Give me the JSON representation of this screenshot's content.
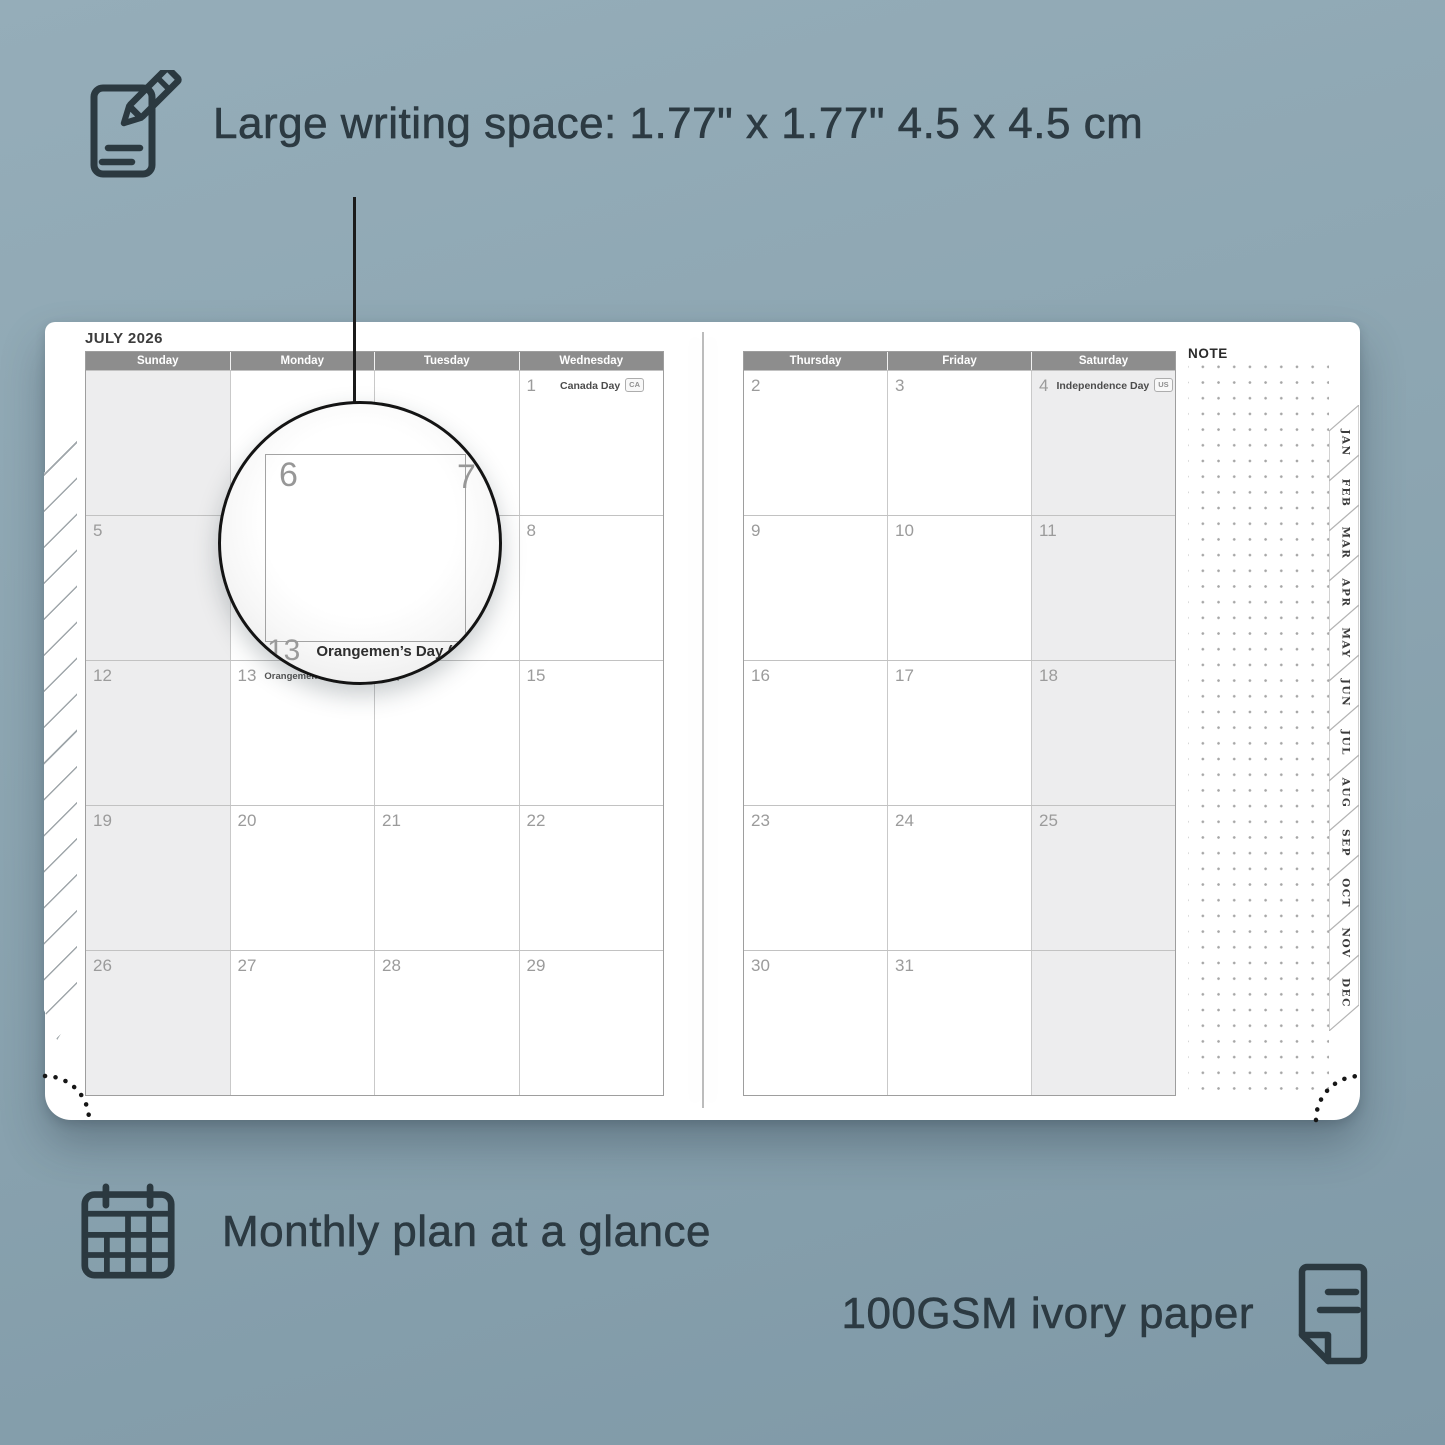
{
  "features": {
    "writing_space": {
      "icon": "pencil-note-icon",
      "label": "Large writing space: 1.77\" x 1.77\" 4.5 x 4.5 cm"
    },
    "monthly_plan": {
      "icon": "calendar-grid-icon",
      "label": "Monthly plan at a glance"
    },
    "paper": {
      "icon": "paper-icon",
      "label": "100GSM ivory paper"
    }
  },
  "planner": {
    "month_title": "JULY 2026",
    "note_label": "NOTE",
    "month_tabs": [
      "JAN",
      "FEB",
      "MAR",
      "APR",
      "MAY",
      "JUN",
      "JUL",
      "AUG",
      "SEP",
      "OCT",
      "NOV",
      "DEC"
    ],
    "left_page": {
      "headers": [
        "Sunday",
        "Monday",
        "Tuesday",
        "Wednesday"
      ],
      "shaded_column": 0,
      "rows": [
        [
          {
            "day": ""
          },
          {
            "day": ""
          },
          {
            "day": ""
          },
          {
            "day": "1",
            "holiday": "Canada Day",
            "badge": "CA",
            "holiday_align": "right"
          }
        ],
        [
          {
            "day": "5"
          },
          {
            "day": "6"
          },
          {
            "day": "7"
          },
          {
            "day": "8"
          }
        ],
        [
          {
            "day": "12"
          },
          {
            "day": "13",
            "holiday": "Orangemen’s Day (n.i.)",
            "badge": "UK",
            "holiday_align": "inline"
          },
          {
            "day": "14"
          },
          {
            "day": "15"
          }
        ],
        [
          {
            "day": "19"
          },
          {
            "day": "20"
          },
          {
            "day": "21"
          },
          {
            "day": "22"
          }
        ],
        [
          {
            "day": "26"
          },
          {
            "day": "27"
          },
          {
            "day": "28"
          },
          {
            "day": "29"
          }
        ]
      ]
    },
    "right_page": {
      "headers": [
        "Thursday",
        "Friday",
        "Saturday"
      ],
      "shaded_column": 2,
      "rows": [
        [
          {
            "day": "2"
          },
          {
            "day": "3"
          },
          {
            "day": "4",
            "holiday": "Independence Day",
            "badge": "US",
            "holiday_align": "right"
          }
        ],
        [
          {
            "day": "9"
          },
          {
            "day": "10"
          },
          {
            "day": "11"
          }
        ],
        [
          {
            "day": "16"
          },
          {
            "day": "17"
          },
          {
            "day": "18"
          }
        ],
        [
          {
            "day": "23"
          },
          {
            "day": "24"
          },
          {
            "day": "25"
          }
        ],
        [
          {
            "day": "30"
          },
          {
            "day": "31"
          },
          {
            "day": ""
          }
        ]
      ]
    },
    "magnifier": {
      "day": "6",
      "next_day": "7",
      "below_day": "13",
      "holiday": "Orangemen’s Day (n.i.)",
      "badge": "UK"
    }
  },
  "colors": {
    "background": "#8ca5b1",
    "caption_text": "#2c3a42",
    "header_bar": "#8d8d8d",
    "shaded_cell": "#ededee",
    "day_number": "#9b9b9b"
  }
}
